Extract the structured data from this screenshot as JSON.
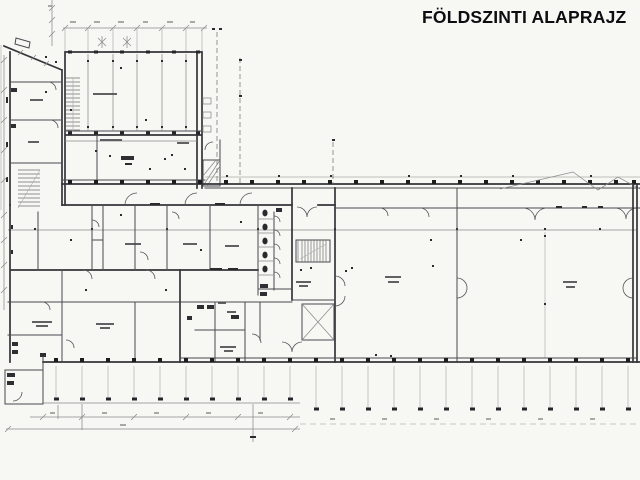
{
  "title": {
    "text": "FÖLDSZINTI ALAPRAJZ"
  },
  "colors": {
    "paper": "#f7f7f4",
    "title_ink": "#0d0d12",
    "wall_ink": "#35353a",
    "column_ink": "#1d1d1f",
    "dimension_ink": "#8b8b8b"
  }
}
